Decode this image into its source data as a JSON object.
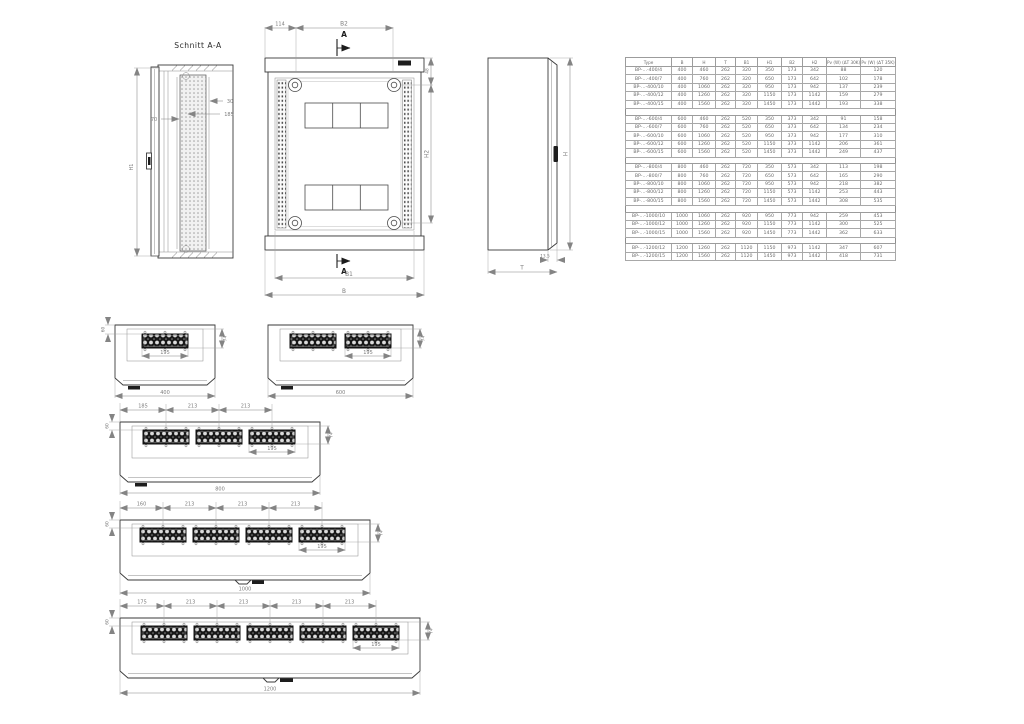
{
  "section_view": {
    "title": "Schnitt A-A",
    "dim_clearance": "70",
    "dim_plate_offset": "30",
    "dim_plate_depth": "185",
    "dim_height": "H1"
  },
  "front_view": {
    "dim_side_offset": "114",
    "dim_fixing_width": "B2",
    "cut_top": "A",
    "cut_bottom": "A",
    "dim_top_offset": "48",
    "dim_fixing_height": "H2",
    "dim_inner_width": "B1",
    "dim_width": "B"
  },
  "side_view": {
    "dim_height": "H",
    "dim_door": "13.5",
    "dim_depth": "T"
  },
  "spec_table": {
    "headers": [
      "Type",
      "B",
      "H",
      "T",
      "B1",
      "H1",
      "B2",
      "H2",
      "Pv (W) (ΔT 30K)",
      "Pv (W) (ΔT 35K)"
    ],
    "groups": [
      {
        "rows": [
          [
            "BP-...-400/4",
            "400",
            "460",
            "262",
            "320",
            "350",
            "173",
            "342",
            "88",
            "120"
          ],
          [
            "BP-...-400/7",
            "400",
            "760",
            "262",
            "320",
            "650",
            "173",
            "642",
            "102",
            "178"
          ],
          [
            "BP-...-400/10",
            "400",
            "1060",
            "262",
            "320",
            "950",
            "173",
            "942",
            "137",
            "239"
          ],
          [
            "BP-...-400/12",
            "400",
            "1260",
            "262",
            "320",
            "1150",
            "173",
            "1142",
            "159",
            "279"
          ],
          [
            "BP-...-400/15",
            "400",
            "1560",
            "262",
            "320",
            "1450",
            "173",
            "1442",
            "193",
            "338"
          ]
        ]
      },
      {
        "rows": [
          [
            "BP-...-600/4",
            "600",
            "460",
            "262",
            "520",
            "350",
            "373",
            "342",
            "91",
            "158"
          ],
          [
            "BP-...-600/7",
            "600",
            "760",
            "262",
            "520",
            "650",
            "373",
            "642",
            "134",
            "234"
          ],
          [
            "BP-...-600/10",
            "600",
            "1060",
            "262",
            "520",
            "950",
            "373",
            "942",
            "177",
            "310"
          ],
          [
            "BP-...-600/12",
            "600",
            "1260",
            "262",
            "520",
            "1150",
            "373",
            "1142",
            "206",
            "361"
          ],
          [
            "BP-...-600/15",
            "600",
            "1560",
            "262",
            "520",
            "1450",
            "373",
            "1442",
            "249",
            "437"
          ]
        ]
      },
      {
        "rows": [
          [
            "BP-...-800/4",
            "800",
            "460",
            "262",
            "720",
            "350",
            "573",
            "342",
            "113",
            "198"
          ],
          [
            "BP-...-800/7",
            "800",
            "760",
            "262",
            "720",
            "650",
            "573",
            "642",
            "165",
            "290"
          ],
          [
            "BP-...-800/10",
            "800",
            "1060",
            "262",
            "720",
            "950",
            "573",
            "942",
            "218",
            "382"
          ],
          [
            "BP-...-800/12",
            "800",
            "1260",
            "262",
            "720",
            "1150",
            "573",
            "1142",
            "253",
            "443"
          ],
          [
            "BP-...-800/15",
            "800",
            "1560",
            "262",
            "720",
            "1450",
            "573",
            "1442",
            "308",
            "535"
          ]
        ]
      },
      {
        "rows": [
          [
            "BP-...-1000/10",
            "1000",
            "1060",
            "262",
            "920",
            "950",
            "773",
            "942",
            "259",
            "453"
          ],
          [
            "BP-...-1000/12",
            "1000",
            "1260",
            "262",
            "920",
            "1150",
            "773",
            "1142",
            "300",
            "525"
          ],
          [
            "BP-...-1000/15",
            "1000",
            "1560",
            "262",
            "920",
            "1450",
            "773",
            "1442",
            "362",
            "633"
          ]
        ]
      },
      {
        "rows": [
          [
            "BP-...-1200/12",
            "1200",
            "1260",
            "262",
            "1120",
            "1150",
            "973",
            "1142",
            "347",
            "607"
          ],
          [
            "BP-...-1200/15",
            "1200",
            "1560",
            "262",
            "1120",
            "1450",
            "973",
            "1442",
            "418",
            "731"
          ]
        ]
      }
    ]
  },
  "top_views": [
    {
      "total": "400",
      "flange": "195",
      "left": "60",
      "right": "74",
      "pitches": []
    },
    {
      "total": "600",
      "flange": "195",
      "right": "74",
      "pitches": []
    },
    {
      "total": "800",
      "flange": "195",
      "left": "60",
      "right": "74",
      "pitches": [
        "185",
        "213",
        "213"
      ]
    },
    {
      "total": "1000",
      "flange": "195",
      "left": "60",
      "right": "74",
      "pitches": [
        "160",
        "213",
        "213",
        "213"
      ]
    },
    {
      "total": "1200",
      "flange": "195",
      "left": "60",
      "right": "74",
      "pitches": [
        "175",
        "213",
        "213",
        "213",
        "213"
      ]
    }
  ]
}
